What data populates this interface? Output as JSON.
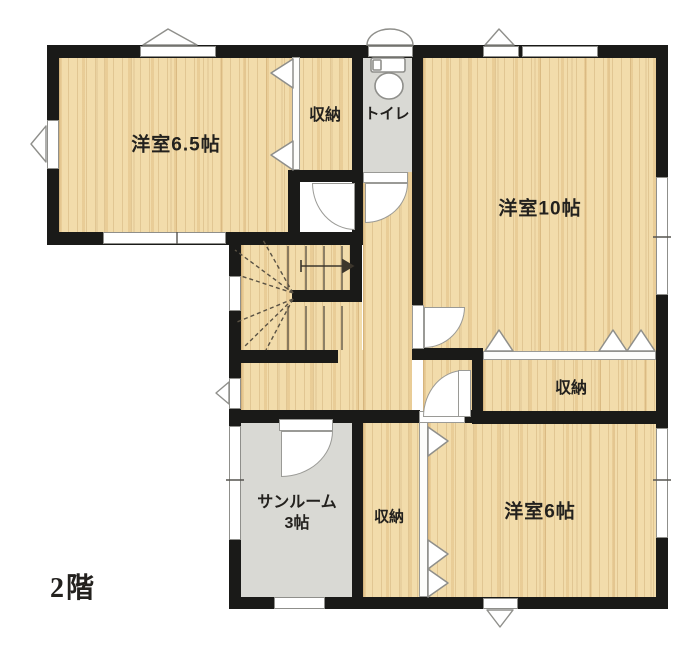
{
  "floor_label": "2階",
  "rooms": {
    "western_6_5": {
      "label": "洋室6.5帖"
    },
    "western_10": {
      "label": "洋室10帖"
    },
    "western_6": {
      "label": "洋室6帖"
    },
    "sunroom": {
      "label": "サンルーム",
      "size_label": "3帖"
    },
    "toilet": {
      "label": "トイレ"
    },
    "closet_top": {
      "label": "収納"
    },
    "closet_right": {
      "label": "収納"
    },
    "closet_bottom": {
      "label": "収納"
    }
  },
  "colors": {
    "wood_floor": "#f2dcab",
    "tile_floor": "#d9d9d4",
    "wall": "#1a1a18",
    "window_fill": "#ffffff",
    "symbol_outline": "#8f8f8b"
  }
}
